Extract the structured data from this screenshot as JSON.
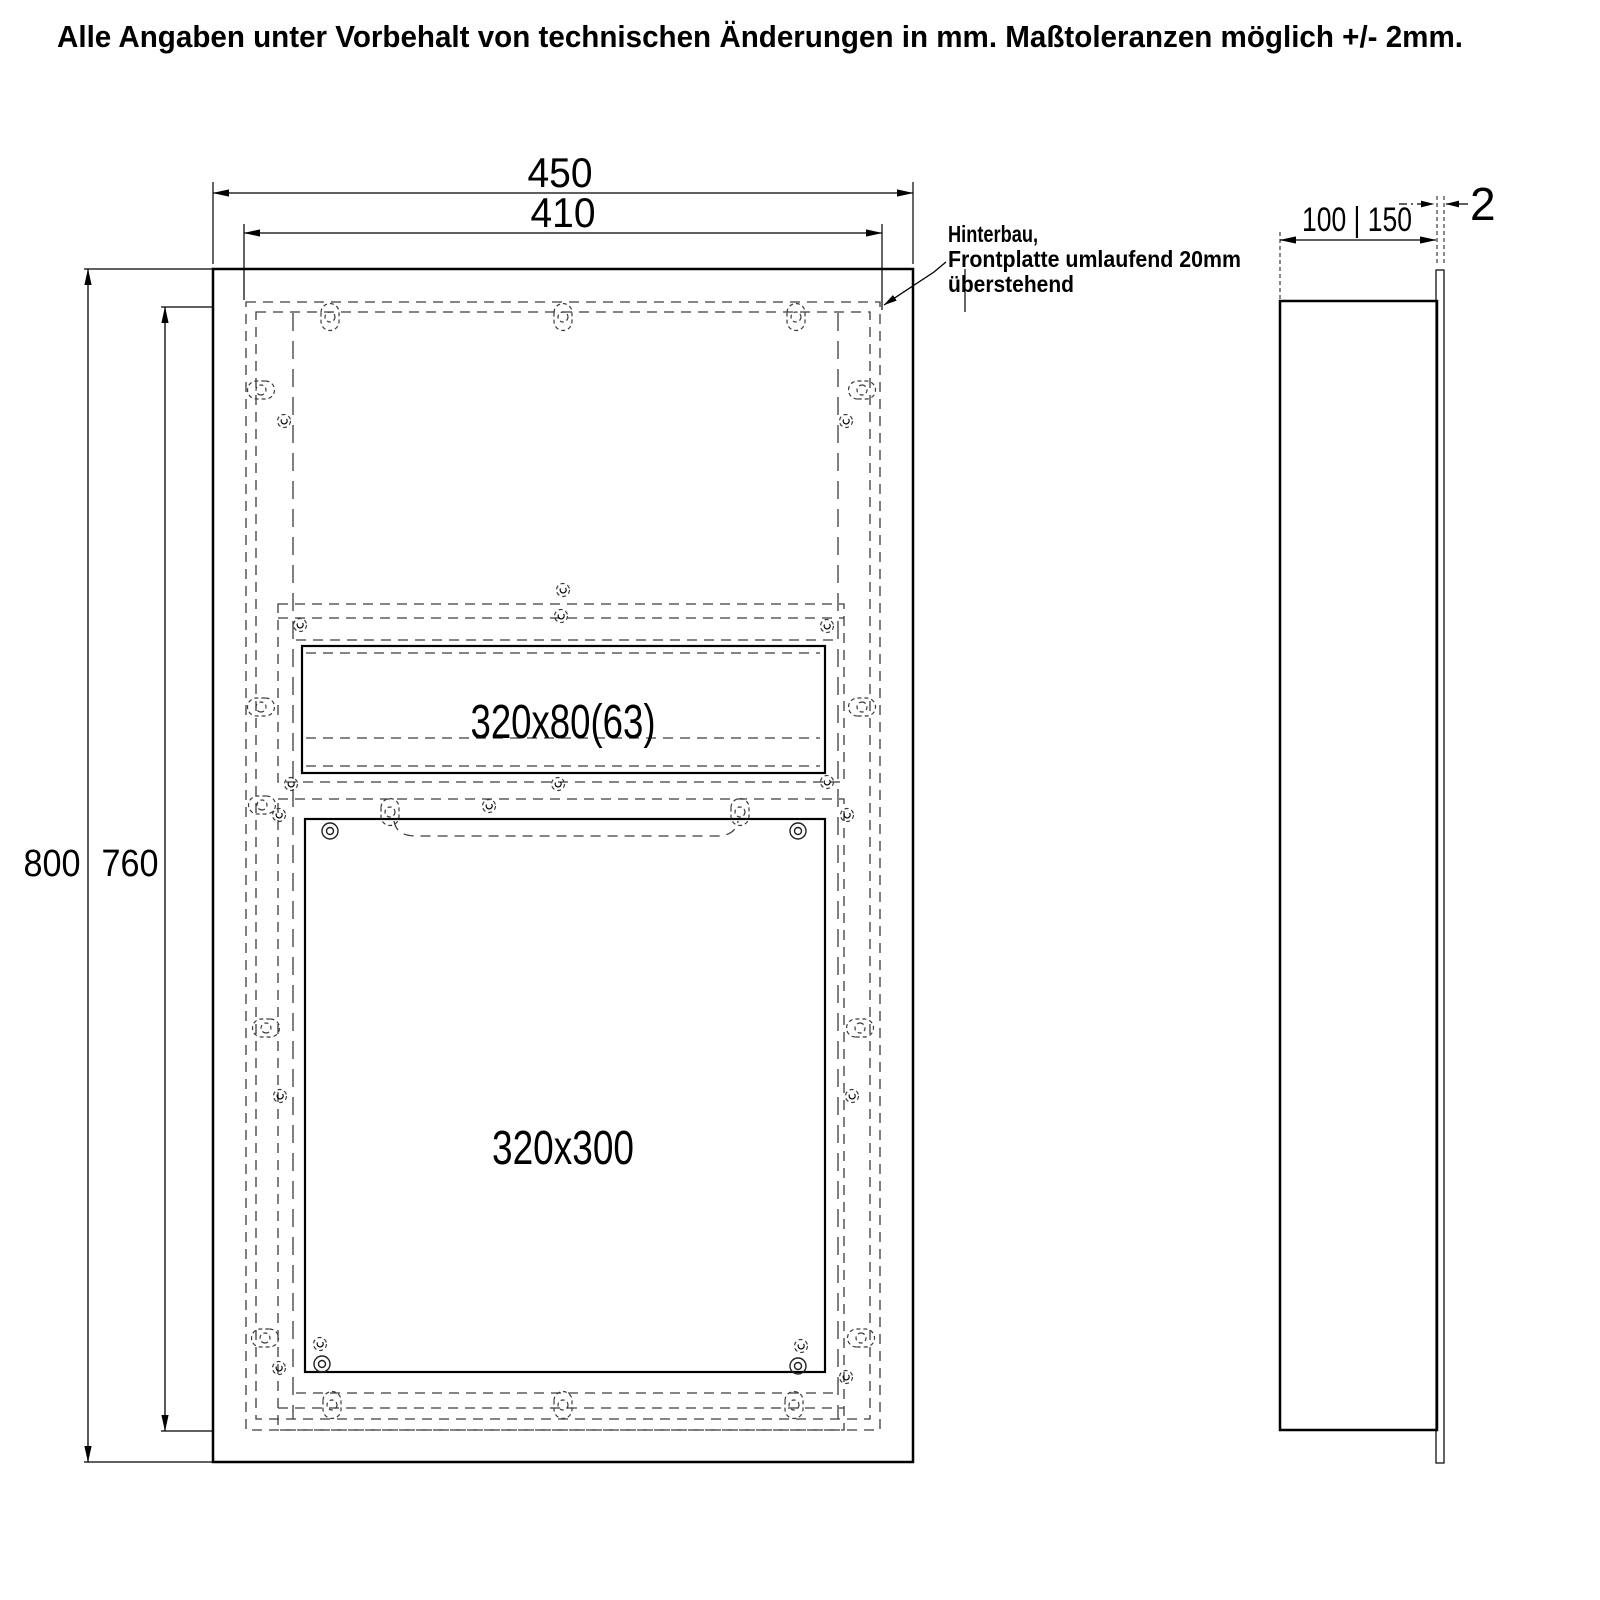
{
  "note": "Alle Angaben unter Vorbehalt von technischen Änderungen in mm. Maßtoleranzen möglich +/- 2mm.",
  "front": {
    "width_outer": "450",
    "width_inner": "410",
    "height_outer": "800",
    "height_inner": "760",
    "slot_cutout": "320x80(63)",
    "door_cutout": "320x300"
  },
  "side": {
    "depth_options": "100 | 150",
    "plate_thickness": "2"
  },
  "annotation": {
    "color": "#cc1a1a",
    "line1": "Hinterbau,",
    "line2": "Frontplatte umlaufend 20mm",
    "line3": "überstehend"
  }
}
